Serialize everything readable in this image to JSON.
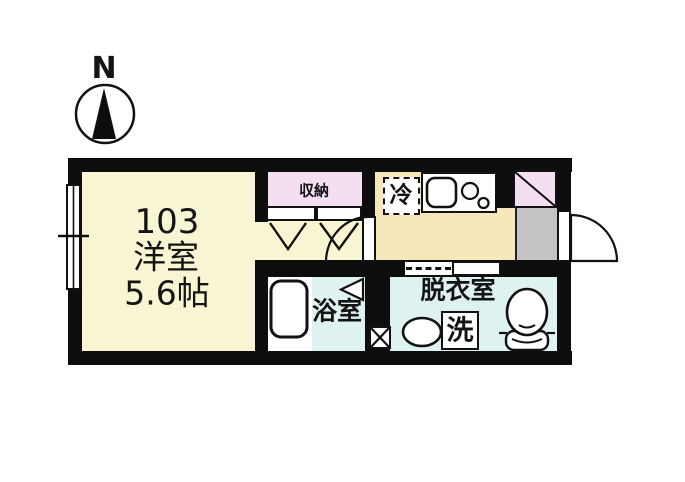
{
  "compass": {
    "north_label": "N"
  },
  "unit": {
    "room_number": "103",
    "room_type": "洋室",
    "room_size": "5.6帖"
  },
  "labels": {
    "closet": "収納",
    "refrigerator": "冷",
    "bathroom": "浴室",
    "dressing_room": "脱衣室",
    "washing_machine": "洗"
  },
  "colors": {
    "wall": "#0d0d0d",
    "main_room_floor": "#f8f6d2",
    "closet_fill": "#f3dff0",
    "kitchen_floor": "#f6e7bd",
    "wet_area_floor": "#def2f2",
    "entrance_floor": "#c3c3c6",
    "fixture_fill": "#ffffff"
  }
}
